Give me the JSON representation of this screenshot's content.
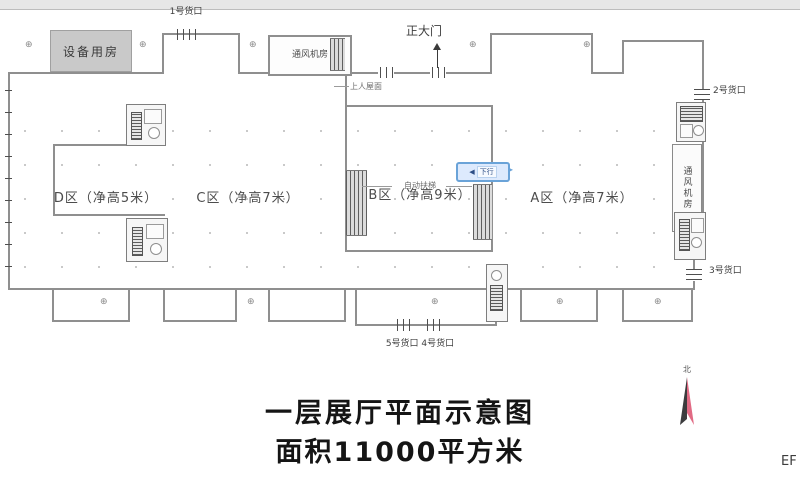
{
  "plan": {
    "zones": [
      {
        "label": "D区（净高5米）"
      },
      {
        "label": "C区（净高7米）"
      },
      {
        "label": "B区（净高9米）"
      },
      {
        "label": "A区（净高7米）"
      }
    ],
    "rooms": {
      "equipment": "设备用房",
      "fan_top": "通风机房",
      "fan_right": "通风机房"
    },
    "doors": {
      "gate1": "1号货口",
      "gate2": "2号货口",
      "gate3": "3号货口",
      "gate45": "5号货口 4号货口",
      "main": "正大门"
    },
    "annotations": {
      "escalator": "自动扶梯",
      "roof": "上人屋面",
      "marker_text": "下行"
    },
    "compass": "北"
  },
  "title": {
    "line1": "一层展厅平面示意图",
    "line2": "面积11000平方米"
  },
  "watermark": "EF",
  "icons": {
    "grid_marker": "⊕",
    "left_arrow": "◀",
    "right_arrow": "▸"
  },
  "colors": {
    "wall": "#8f8f8f",
    "marker_blue": "#6aa3d8",
    "compass_pink": "#e16a84",
    "compass_dark": "#3b3b3d",
    "equipment_gray": "#c9c9c9"
  }
}
